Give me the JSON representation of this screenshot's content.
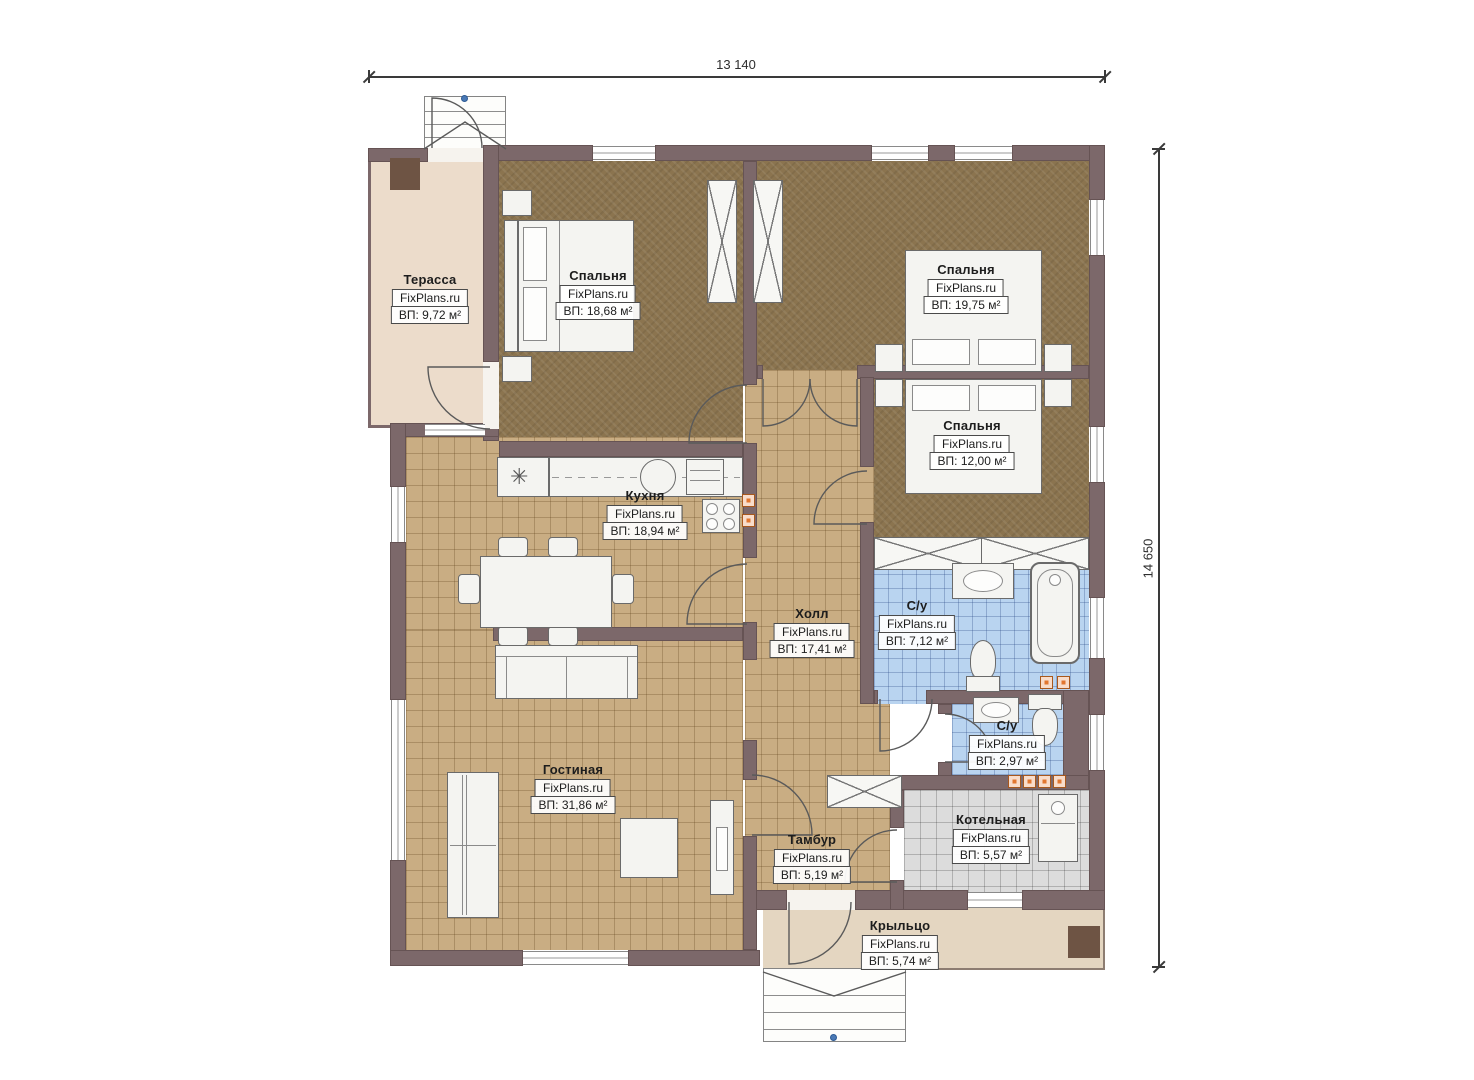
{
  "brand": "FixPlans.ru",
  "dimensions": {
    "width_label": "13 140",
    "height_label": "14 650"
  },
  "icons": {
    "vent_star": "✳"
  },
  "colors": {
    "wall": "#7c686a",
    "tile_tan": "#c9ad83",
    "carpet_brown": "#8b744f",
    "tile_blue": "#b9d4f0",
    "tile_gray": "#dcdcdc",
    "terrace": "#ecdccb",
    "porch": "#e4d6c1",
    "socket_orange": "#e2762f"
  },
  "rooms": [
    {
      "id": "terrace",
      "name": "Терасса",
      "area": "ВП: 9,72 м²"
    },
    {
      "id": "bedroom1",
      "name": "Спальня",
      "area": "ВП: 18,68 м²"
    },
    {
      "id": "bedroom2",
      "name": "Спальня",
      "area": "ВП: 19,75 м²"
    },
    {
      "id": "bedroom3",
      "name": "Спальня",
      "area": "ВП: 12,00 м²"
    },
    {
      "id": "kitchen",
      "name": "Кухня",
      "area": "ВП: 18,94 м²"
    },
    {
      "id": "hall",
      "name": "Холл",
      "area": "ВП: 17,41 м²"
    },
    {
      "id": "bath1",
      "name": "С/у",
      "area": "ВП: 7,12 м²"
    },
    {
      "id": "bath2",
      "name": "С/у",
      "area": "ВП: 2,97 м²"
    },
    {
      "id": "living",
      "name": "Гостиная",
      "area": "ВП: 31,86 м²"
    },
    {
      "id": "tambur",
      "name": "Тамбур",
      "area": "ВП: 5,19 м²"
    },
    {
      "id": "boiler",
      "name": "Котельная",
      "area": "ВП: 5,57 м²"
    },
    {
      "id": "porch",
      "name": "Крыльцо",
      "area": "ВП: 5,74 м²"
    }
  ]
}
